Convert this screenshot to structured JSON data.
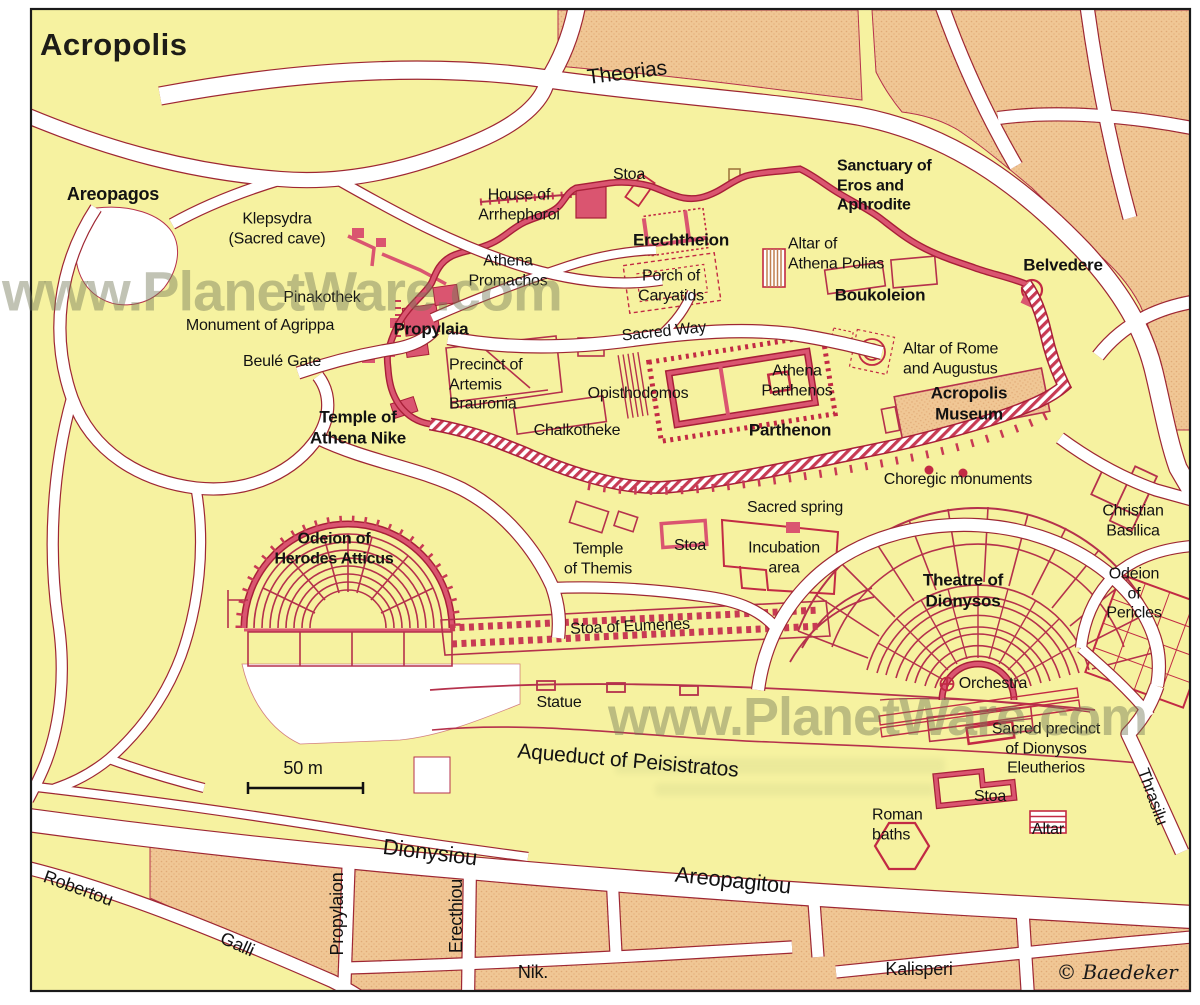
{
  "title": "Acropolis",
  "watermark": "www.PlanetWare.com",
  "copyright": "© Baedeker",
  "scale": {
    "label": "50 m"
  },
  "streets": {
    "theorias": "Theorias",
    "dionysiou": "Dionysiou",
    "areopagitou": "Areopagitou",
    "robertou": "Robertou",
    "galli": "Galli",
    "propylaion": "Propylaion",
    "erecthiou": "Erecthiou",
    "nik": "Nik.",
    "kalisperi": "Kalisperi",
    "thrasilu": "Thrasilu",
    "aqueduct": "Aqueduct of Peisistratos"
  },
  "sites": {
    "areopagos": "Areopagos",
    "klepsydra": "Klepsydra\n(Sacred cave)",
    "house_arrhephoroi": "House of\nArrhephoroi",
    "stoa_top": "Stoa",
    "sanctuary_eros": "Sanctuary of\nEros and\nAphrodite",
    "erechtheion": "Erechtheion",
    "porch_caryatids": "Porch of\nCaryatids",
    "altar_athena_polias": "Altar of\nAthena Polias",
    "belvedere": "Belvedere",
    "athena_promachos": "Athena\nPromachos",
    "boukoleion": "Boukoleion",
    "pinakothek": "Pinakothek",
    "monument_agrippa": "Monument of Agrippa",
    "propylaia": "Propylaia",
    "sacred_way": "Sacred Way",
    "altar_rome": "Altar of Rome\nand Augustus",
    "beule_gate": "Beulé Gate",
    "precinct_artemis": "Precinct of\nArtemis\nBrauronia",
    "opisthodomos": "Opisthodomos",
    "athena_parthenos": "Athena\nParthenos",
    "acropolis_museum": "Acropolis\nMuseum",
    "temple_athena_nike": "Temple of\nAthena Nike",
    "chalkotheke": "Chalkotheke",
    "parthenon": "Parthenon",
    "choregic_monuments": "Choregic monuments",
    "sacred_spring": "Sacred spring",
    "christian_basilica": "Christian\nBasilica",
    "odeion_herodes": "Odeion of\nHerodes Atticus",
    "temple_themis": "Temple\nof Themis",
    "stoa_mid": "Stoa",
    "incubation_area": "Incubation\narea",
    "theatre_dionysos": "Theatre of\nDionysos",
    "odeion_pericles": "Odeion\nof\nPericles",
    "stoa_eumenes": "Stoa of Eumenes",
    "statue": "Statue",
    "orchestra": "Orchestra",
    "sacred_precinct": "Sacred precinct\nof Dionysos\nEleutherios",
    "stoa_bottom": "Stoa",
    "roman_baths": "Roman\nbaths",
    "altar_bottom": "Altar"
  },
  "colors": {
    "background": "#F6F2A0",
    "block_tan": "#F0C795",
    "road_fill": "#FFFFFF",
    "road_casing": "#9E2733",
    "ruin_line": "#B5314C",
    "wall_pink": "#DA5570",
    "wall_dark": "#A81F38",
    "watermark": "#767B58"
  }
}
